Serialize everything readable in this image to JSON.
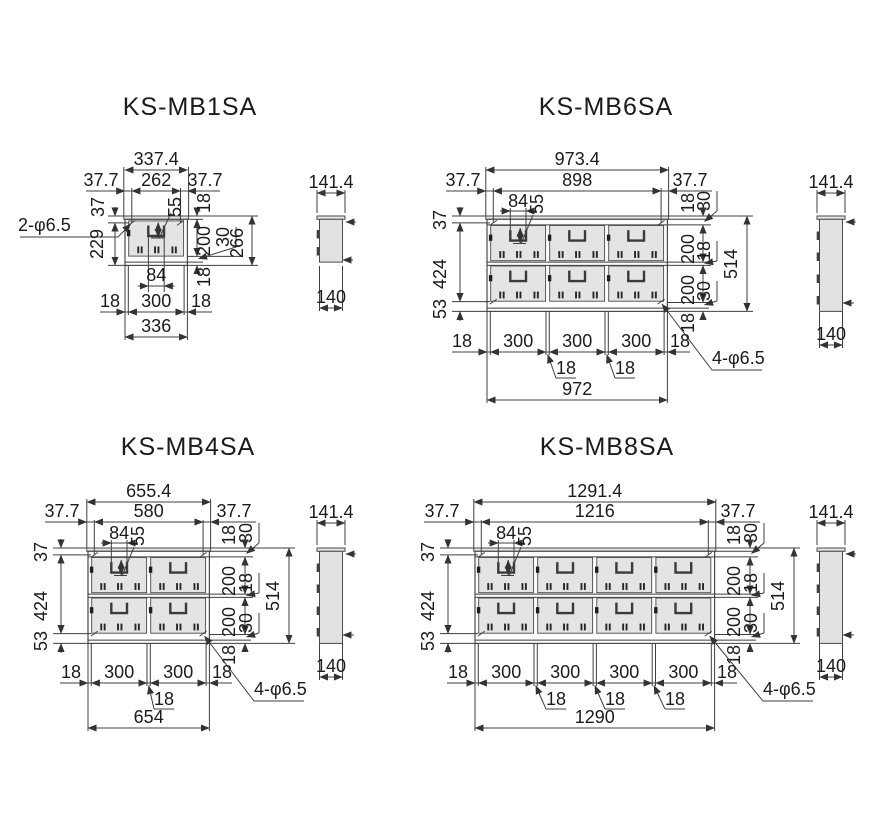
{
  "drawing": {
    "background": "#ffffff",
    "line_color": "#3f3f3f",
    "text_color": "#1b1b1b",
    "door_fill": "#e4e4e4",
    "units": "mm"
  },
  "mb1": {
    "title": "KS-MB1SA",
    "front": {
      "overall_w": "337.4",
      "margin_l": "37.7",
      "hole_span": "262",
      "margin_r": "37.7",
      "hole_note": "2-φ6.5",
      "top_offset": "37",
      "handle_drop": "55",
      "flange_top": "18",
      "body_h": "229",
      "door_h": "200",
      "gap_30": "30",
      "overall_h": "266",
      "flange_bottom": "18",
      "handle_w": "84",
      "foot_l": "18",
      "unit_w": "300",
      "foot_r": "18",
      "body_w": "336"
    },
    "side": {
      "overall_d": "141.4",
      "body_d": "140"
    }
  },
  "mb6": {
    "title": "KS-MB6SA",
    "front": {
      "overall_w": "973.4",
      "hole_span": "898",
      "margin_l": "37.7",
      "margin_r": "37.7",
      "handle_w": "84",
      "handle_drop": "55",
      "top_offset": "37",
      "col_h": "424",
      "bottom_offset": "53",
      "flange_top": "18",
      "gap_30": "30",
      "door_h": "200",
      "row_gap": "18",
      "overall_h": "514",
      "flange_bottom": "18",
      "foot_l": "18",
      "unit_w": "300",
      "div_gap": "18",
      "foot_r": "18",
      "body_w": "972",
      "hole_note": "4-φ6.5"
    },
    "side": {
      "overall_d": "141.4",
      "body_d": "140"
    }
  },
  "mb4": {
    "title": "KS-MB4SA",
    "front": {
      "overall_w": "655.4",
      "hole_span": "580",
      "margin_l": "37.7",
      "margin_r": "37.7",
      "handle_w": "84",
      "handle_drop": "55",
      "top_offset": "37",
      "col_h": "424",
      "bottom_offset": "53",
      "flange_top": "18",
      "gap_30": "30",
      "door_h": "200",
      "row_gap": "18",
      "overall_h": "514",
      "flange_bottom": "18",
      "foot_l": "18",
      "unit_w": "300",
      "div_gap": "18",
      "foot_r": "18",
      "body_w": "654",
      "hole_note": "4-φ6.5"
    },
    "side": {
      "overall_d": "141.4",
      "body_d": "140"
    }
  },
  "mb8": {
    "title": "KS-MB8SA",
    "front": {
      "overall_w": "1291.4",
      "hole_span": "1216",
      "margin_l": "37.7",
      "margin_r": "37.7",
      "handle_w": "84",
      "handle_drop": "55",
      "top_offset": "37",
      "col_h": "424",
      "bottom_offset": "53",
      "flange_top": "18",
      "gap_30": "30",
      "door_h": "200",
      "row_gap": "18",
      "overall_h": "514",
      "flange_bottom": "18",
      "foot_l": "18",
      "unit_w": "300",
      "div_gap": "18",
      "foot_r": "18",
      "body_w": "1290",
      "hole_note": "4-φ6.5"
    },
    "side": {
      "overall_d": "141.4",
      "body_d": "140"
    }
  }
}
